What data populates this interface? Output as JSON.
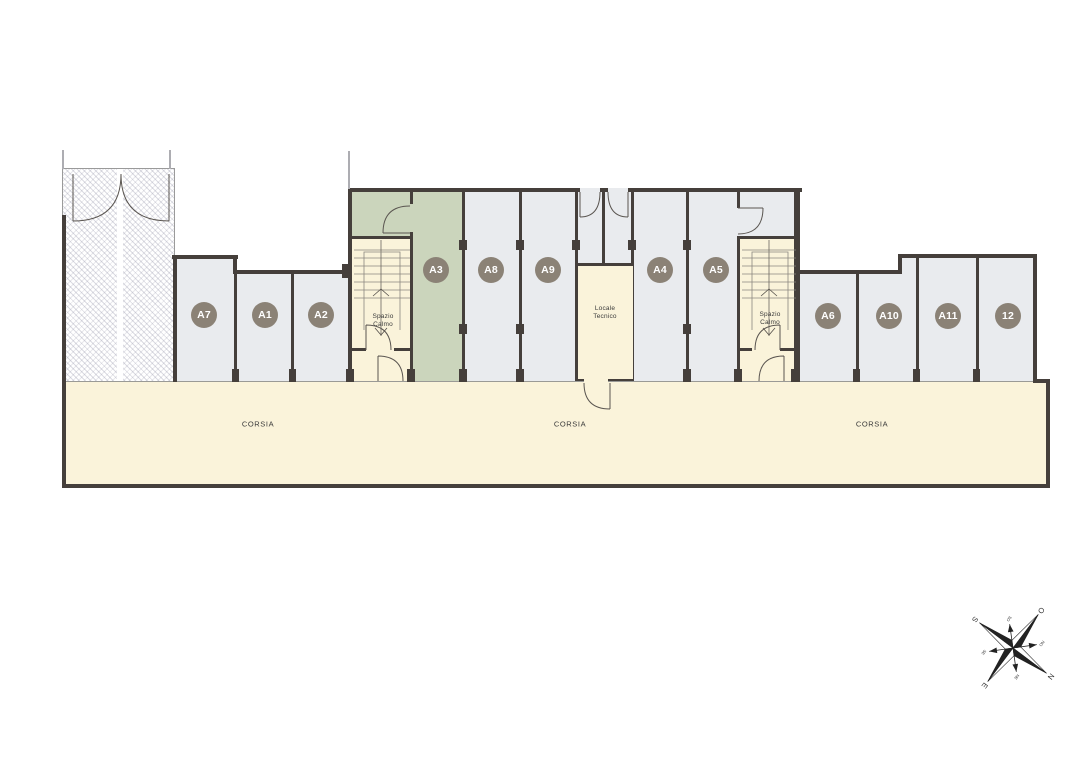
{
  "plan": {
    "rooms": [
      {
        "label": "A7"
      },
      {
        "label": "A1"
      },
      {
        "label": "A2"
      },
      {
        "label": "A3",
        "highlighted": true
      },
      {
        "label": "A8"
      },
      {
        "label": "A9"
      },
      {
        "label": "A4"
      },
      {
        "label": "A5"
      },
      {
        "label": "A6"
      },
      {
        "label": "A10"
      },
      {
        "label": "A11"
      },
      {
        "label": "12"
      }
    ],
    "labels": {
      "spazio_calmo": "Spazio\nCalmo",
      "locale_tecnico": "Locale\nTecnico",
      "corsia": "CORSIA"
    },
    "compass": {
      "n": "N",
      "e": "E",
      "s": "S",
      "o": "O",
      "ne": "NE",
      "se": "SE",
      "so": "SO",
      "no": "NO"
    },
    "colors": {
      "room_fill": "#E9EBEE",
      "highlight_fill": "#CBD5BC",
      "circulation_fill": "#FAF3DA",
      "wall": "#453F3B",
      "badge": "#8B8276"
    }
  }
}
